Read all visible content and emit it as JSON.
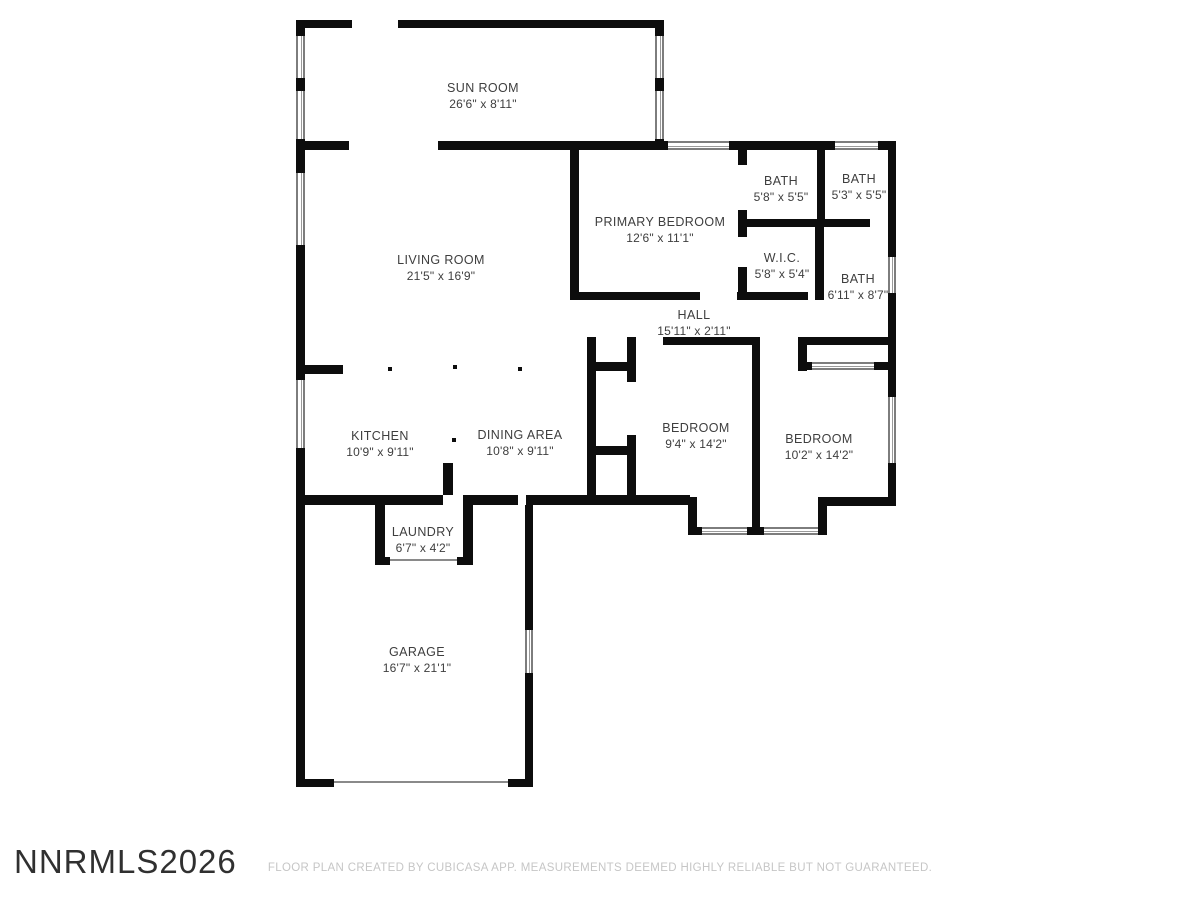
{
  "page": {
    "wall_color": "#0d0d0d",
    "label_color": "#3e3e3e",
    "watermark": "NNRMLS2026",
    "footer": "FLOOR PLAN CREATED BY CUBICASA APP. MEASUREMENTS DEEMED HIGHLY RELIABLE BUT NOT GUARANTEED."
  },
  "rooms": [
    {
      "name": "SUN ROOM",
      "dims": "26'6\" x 8'11\""
    },
    {
      "name": "LIVING ROOM",
      "dims": "21'5\" x 16'9\""
    },
    {
      "name": "PRIMARY BEDROOM",
      "dims": "12'6\" x 11'1\""
    },
    {
      "name": "BATH",
      "dims": "5'8\" x 5'5\""
    },
    {
      "name": "BATH",
      "dims": "5'3\" x 5'5\""
    },
    {
      "name": "W.I.C.",
      "dims": "5'8\" x 5'4\""
    },
    {
      "name": "BATH",
      "dims": "6'11\" x 8'7\""
    },
    {
      "name": "HALL",
      "dims": "15'11\" x 2'11\""
    },
    {
      "name": "BEDROOM",
      "dims": "9'4\" x 14'2\""
    },
    {
      "name": "BEDROOM",
      "dims": "10'2\" x 14'2\""
    },
    {
      "name": "KITCHEN",
      "dims": "10'9\" x 9'11\""
    },
    {
      "name": "DINING AREA",
      "dims": "10'8\" x 9'11\""
    },
    {
      "name": "LAUNDRY",
      "dims": "6'7\" x 4'2\""
    },
    {
      "name": "GARAGE",
      "dims": "16'7\" x 21'1\""
    }
  ]
}
